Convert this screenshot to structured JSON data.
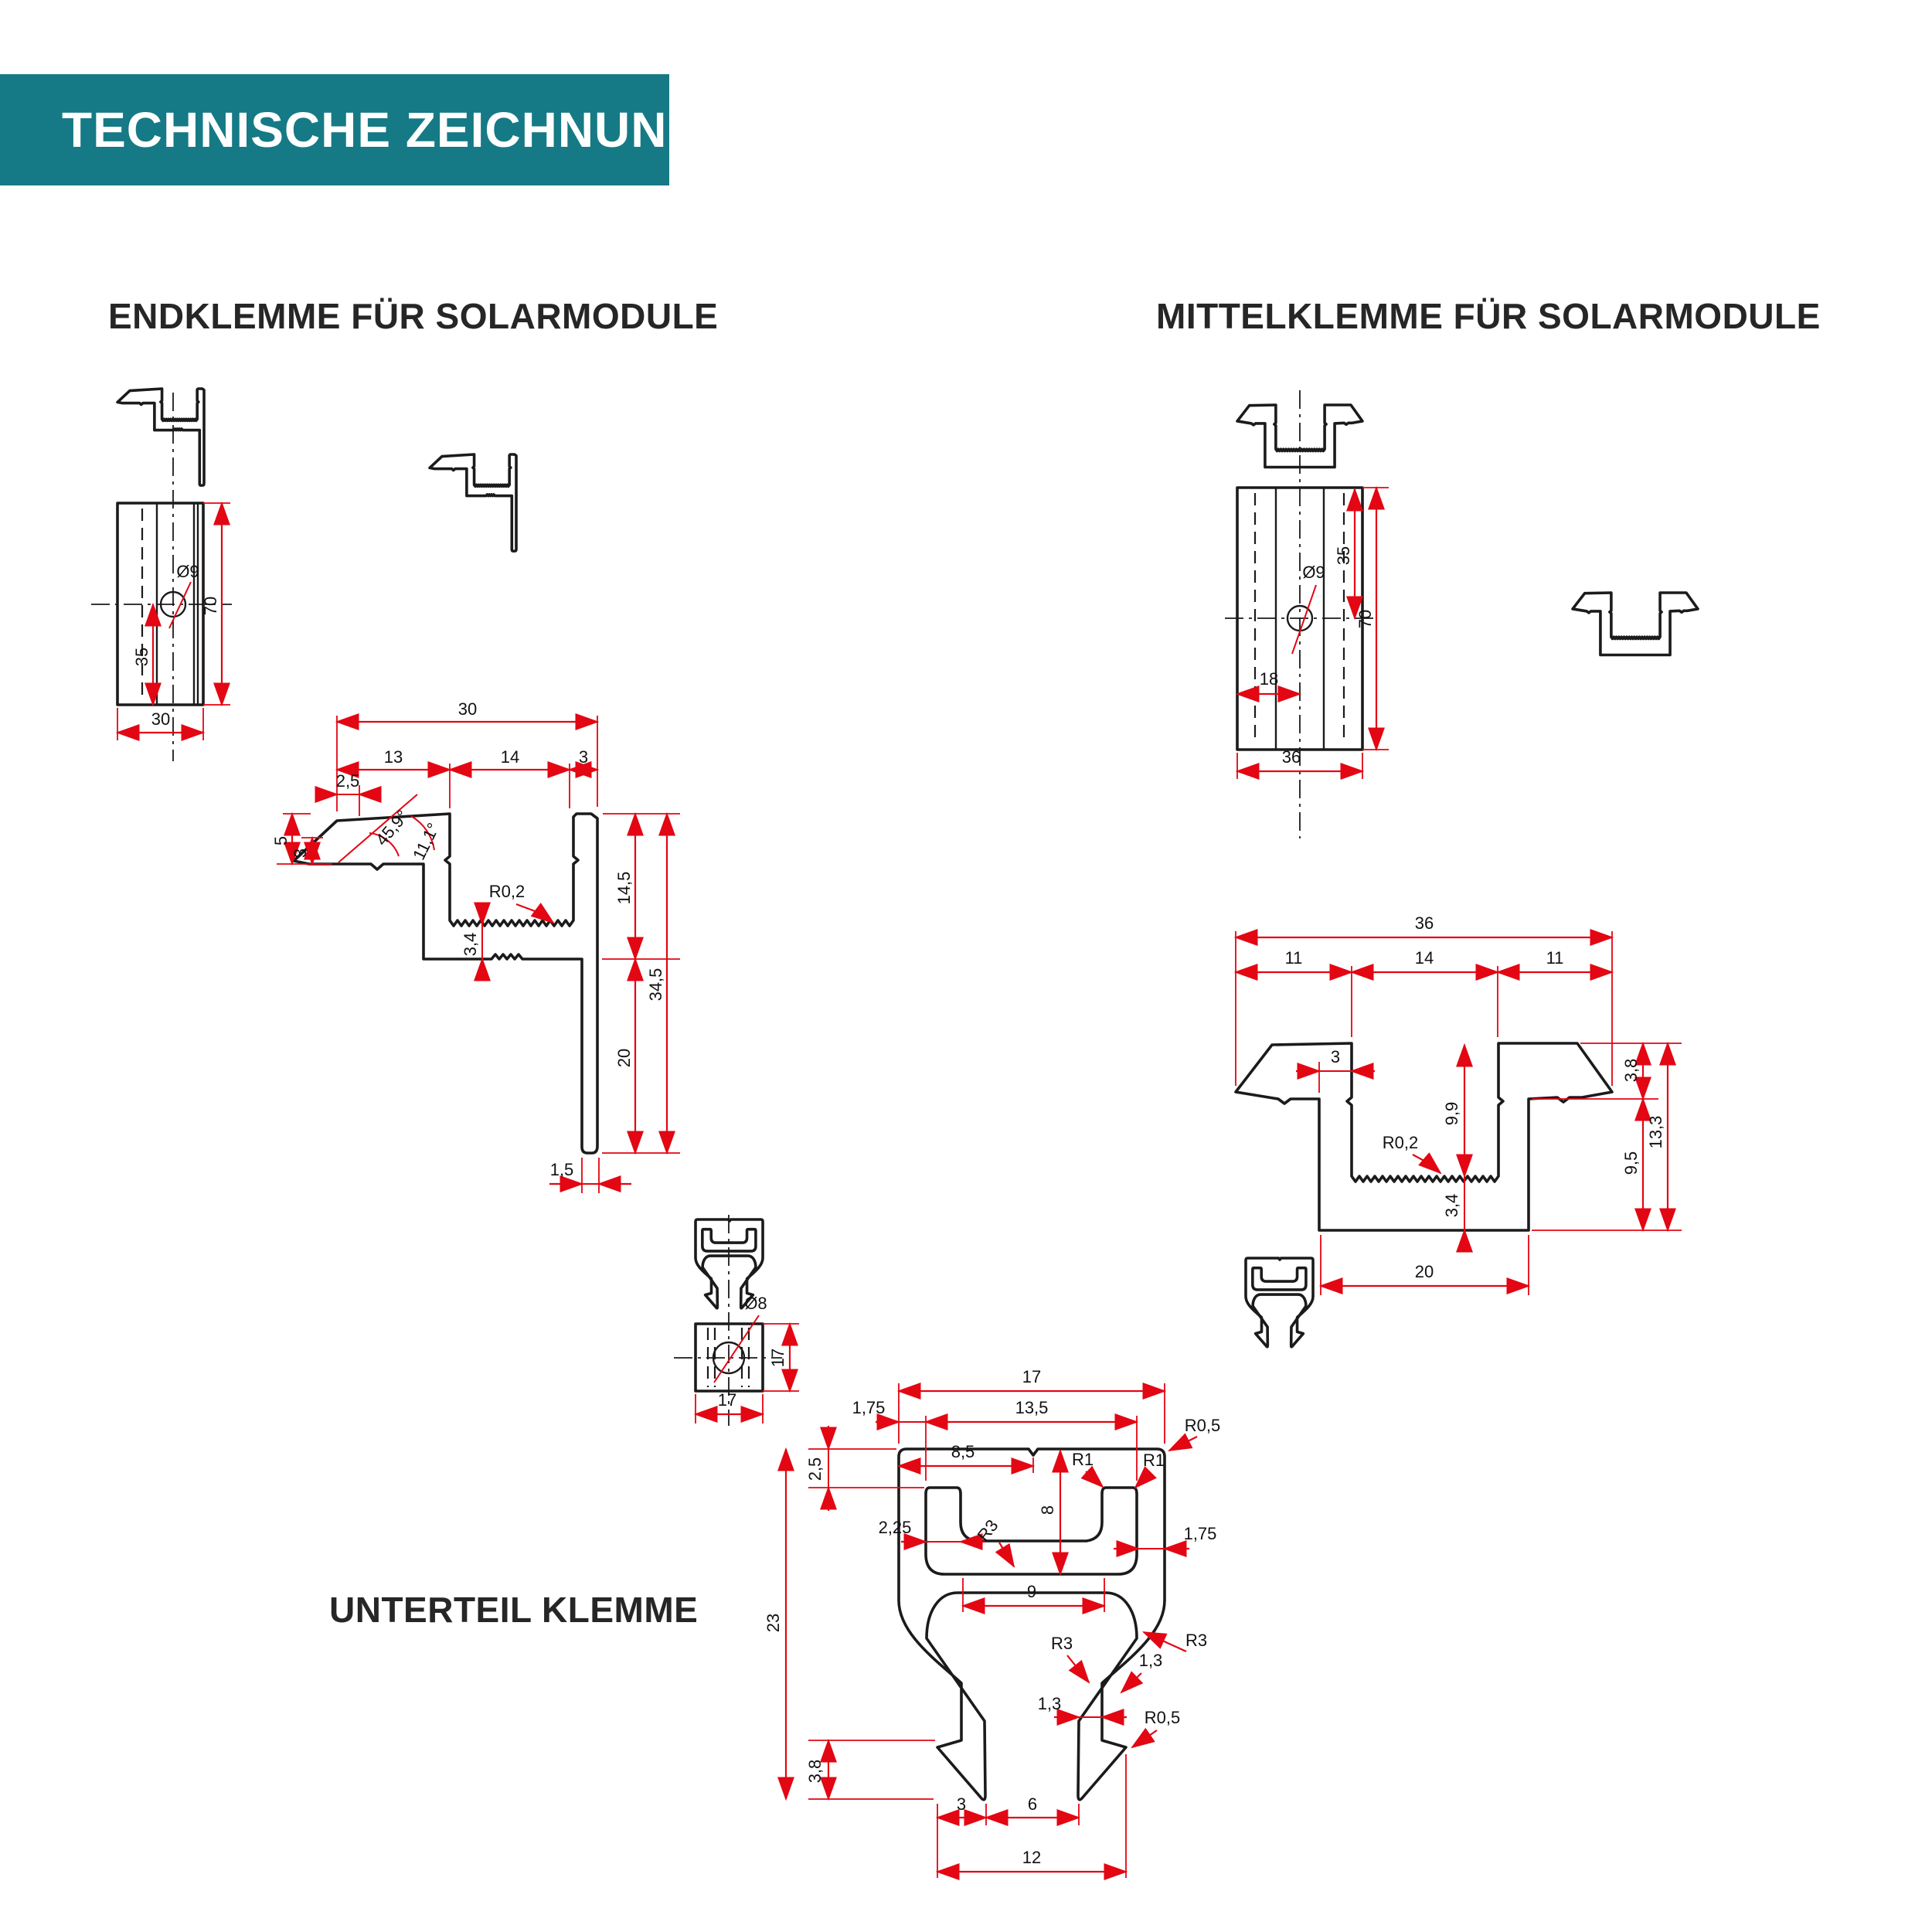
{
  "header": {
    "title": "TECHNISCHE ZEICHNUNG KLICKFIX"
  },
  "colors": {
    "teal": "#157a85",
    "red": "#e30613",
    "ink": "#1b1b1b"
  },
  "endklemme": {
    "title": "ENDKLEMME FÜR SOLARMODULE",
    "plan": {
      "hole": "Ø9",
      "d70": "70",
      "d35": "35",
      "d30": "30"
    },
    "detail": {
      "w30": "30",
      "w13": "13",
      "w14": "14",
      "w3": "3",
      "w25": "2,5",
      "h5": "5",
      "h3": "3",
      "ang1": "45,9°",
      "ang2": "11,1°",
      "r02": "R0,2",
      "t34": "3,4",
      "h145": "14,5",
      "h20": "20",
      "h345": "34,5",
      "t15": "1,5"
    }
  },
  "mittelklemme": {
    "title": "MITTELKLEMME FÜR SOLARMODULE",
    "plan": {
      "hole": "Ø9",
      "d35": "35",
      "d70": "70",
      "d18": "18",
      "d36": "36"
    },
    "detail": {
      "w36": "36",
      "w11l": "11",
      "w14": "14",
      "w11r": "11",
      "w3": "3",
      "h99": "9,9",
      "r02": "R0,2",
      "t34": "3,4",
      "h38": "3,8",
      "h95": "9,5",
      "h133": "13,3",
      "w20": "20"
    }
  },
  "unterteil": {
    "title": "UNTERTEIL KLEMME",
    "plan": {
      "hole": "Ø8",
      "d17v": "17",
      "d17h": "17"
    },
    "detail": {
      "w17": "17",
      "w175l": "1,75",
      "w135": "13,5",
      "r05t": "R0,5",
      "h25": "2,5",
      "w85": "8,5",
      "r1a": "R1",
      "r1b": "R1",
      "w225": "2,25",
      "r3a": "R3",
      "h8": "8",
      "w175r": "1,75",
      "w9": "9",
      "h23": "23",
      "r3b": "R3",
      "r3c": "R3",
      "t13a": "1,3",
      "t13b": "1,3",
      "r05b": "R0,5",
      "h38": "3,8",
      "w3": "3",
      "w6": "6",
      "w12": "12"
    }
  }
}
